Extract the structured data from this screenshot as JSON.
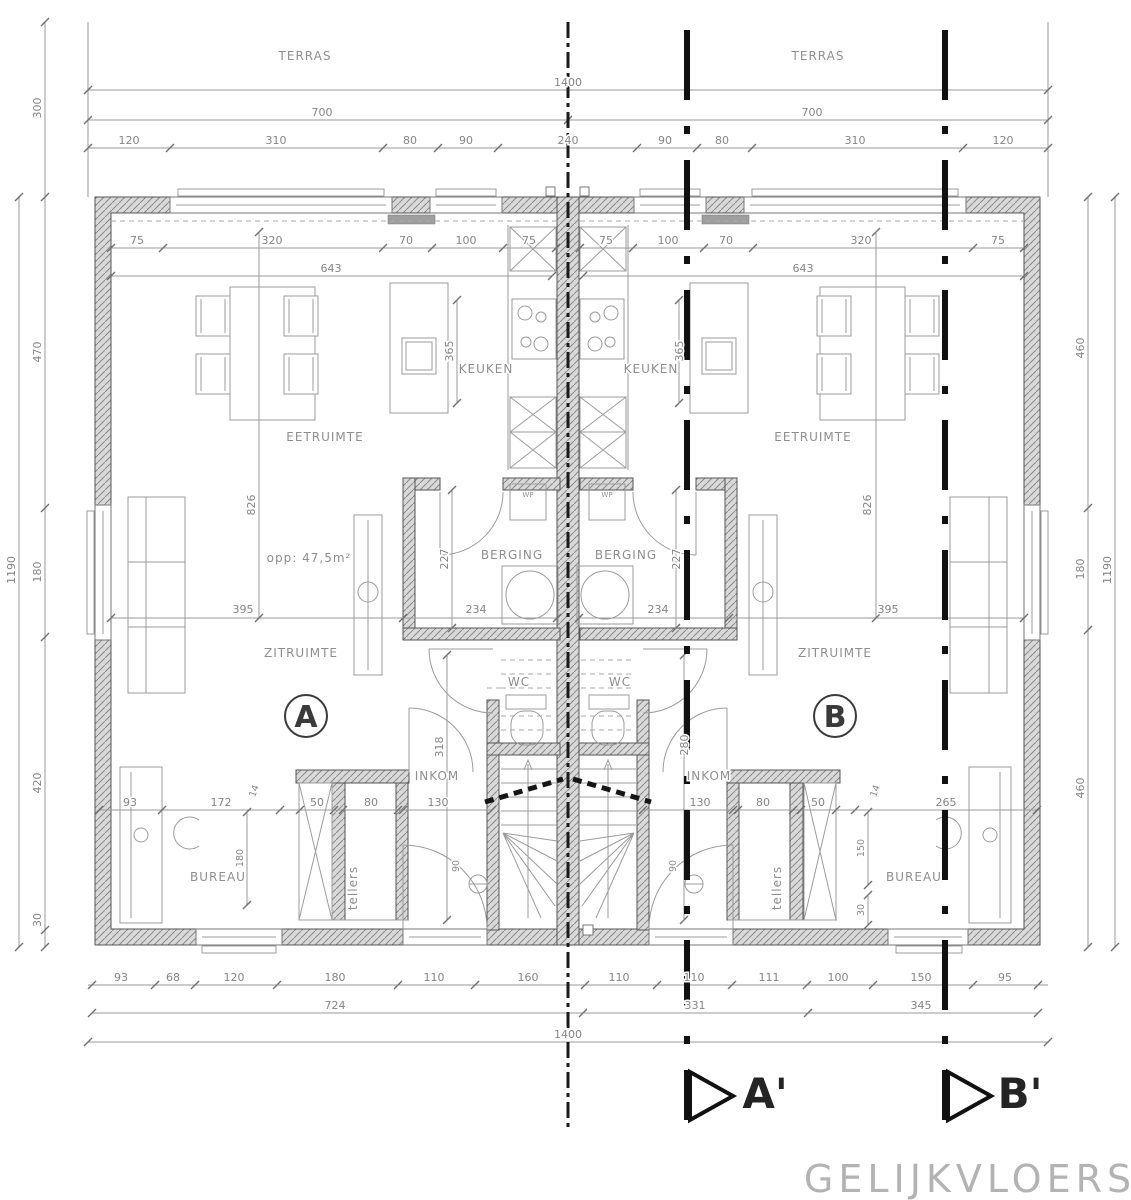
{
  "title": "GELIJKVLOERS",
  "units": {
    "a": "A",
    "b": "B"
  },
  "section_markers": {
    "a": "A'",
    "b": "B'"
  },
  "labels": {
    "terras_l": "TERRAS",
    "terras_r": "TERRAS",
    "keuken_l": "KEUKEN",
    "keuken_r": "KEUKEN",
    "eetruimte_l": "EETRUIMTE",
    "eetruimte_r": "EETRUIMTE",
    "berging_l": "BERGING",
    "berging_r": "BERGING",
    "zitruimte_l": "ZITRUIMTE",
    "zitruimte_r": "ZITRUIMTE",
    "inkom_l": "INKOM",
    "inkom_r": "INKOM",
    "wc_l": "WC",
    "wc_r": "WC",
    "bureau_l": "BUREAU",
    "bureau_r": "BUREAU",
    "tellers_l": "tellers",
    "tellers_r": "tellers",
    "wp_l": "WP",
    "wp_r": "WP",
    "area": "opp: 47,5m²"
  },
  "dims": {
    "t1400": "1400",
    "t700l": "700",
    "t700r": "700",
    "tc": [
      "120",
      "310",
      "80",
      "90",
      "240",
      "90",
      "80",
      "310",
      "120"
    ],
    "l300": "300",
    "l1190": "1190",
    "lc": [
      "470",
      "180",
      "420",
      "30"
    ],
    "rc": [
      "460",
      "180",
      "460"
    ],
    "r1190": "1190",
    "bc": [
      "93",
      "68",
      "120",
      "180",
      "110",
      "160",
      "110",
      "110",
      "111",
      "100",
      "150",
      "95"
    ],
    "b724": "724",
    "b331": "331",
    "b345": "345",
    "b1400": "1400",
    "itl": [
      "75",
      "320",
      "70",
      "100",
      "75"
    ],
    "itl643": "643",
    "itr": [
      "75",
      "100",
      "70",
      "320",
      "75"
    ],
    "itr643": "643",
    "v365l": "365",
    "v365r": "365",
    "v826l": "826",
    "v826r": "826",
    "h395l": "395",
    "h395r": "395",
    "v227l": "227",
    "v227r": "227",
    "h234l": "234",
    "h234r": "234",
    "v318": "318",
    "v280": "280",
    "h130l": "130",
    "h130r": "130",
    "bl": [
      "93",
      "172",
      "50",
      "80"
    ],
    "bl14": "14",
    "bl180": "180",
    "br": [
      "80",
      "50",
      "265"
    ],
    "br14": "14",
    "br150": "150",
    "br30": "30",
    "l90": "90",
    "r90": "90"
  },
  "colors": {
    "wall_fill": "#d9d9d9",
    "wall_hatch": "#8a8a8a",
    "dim_line": "#9a9a9a",
    "dim_text": "#858585",
    "section": "#111111",
    "title_text": "#b3b3b3"
  }
}
